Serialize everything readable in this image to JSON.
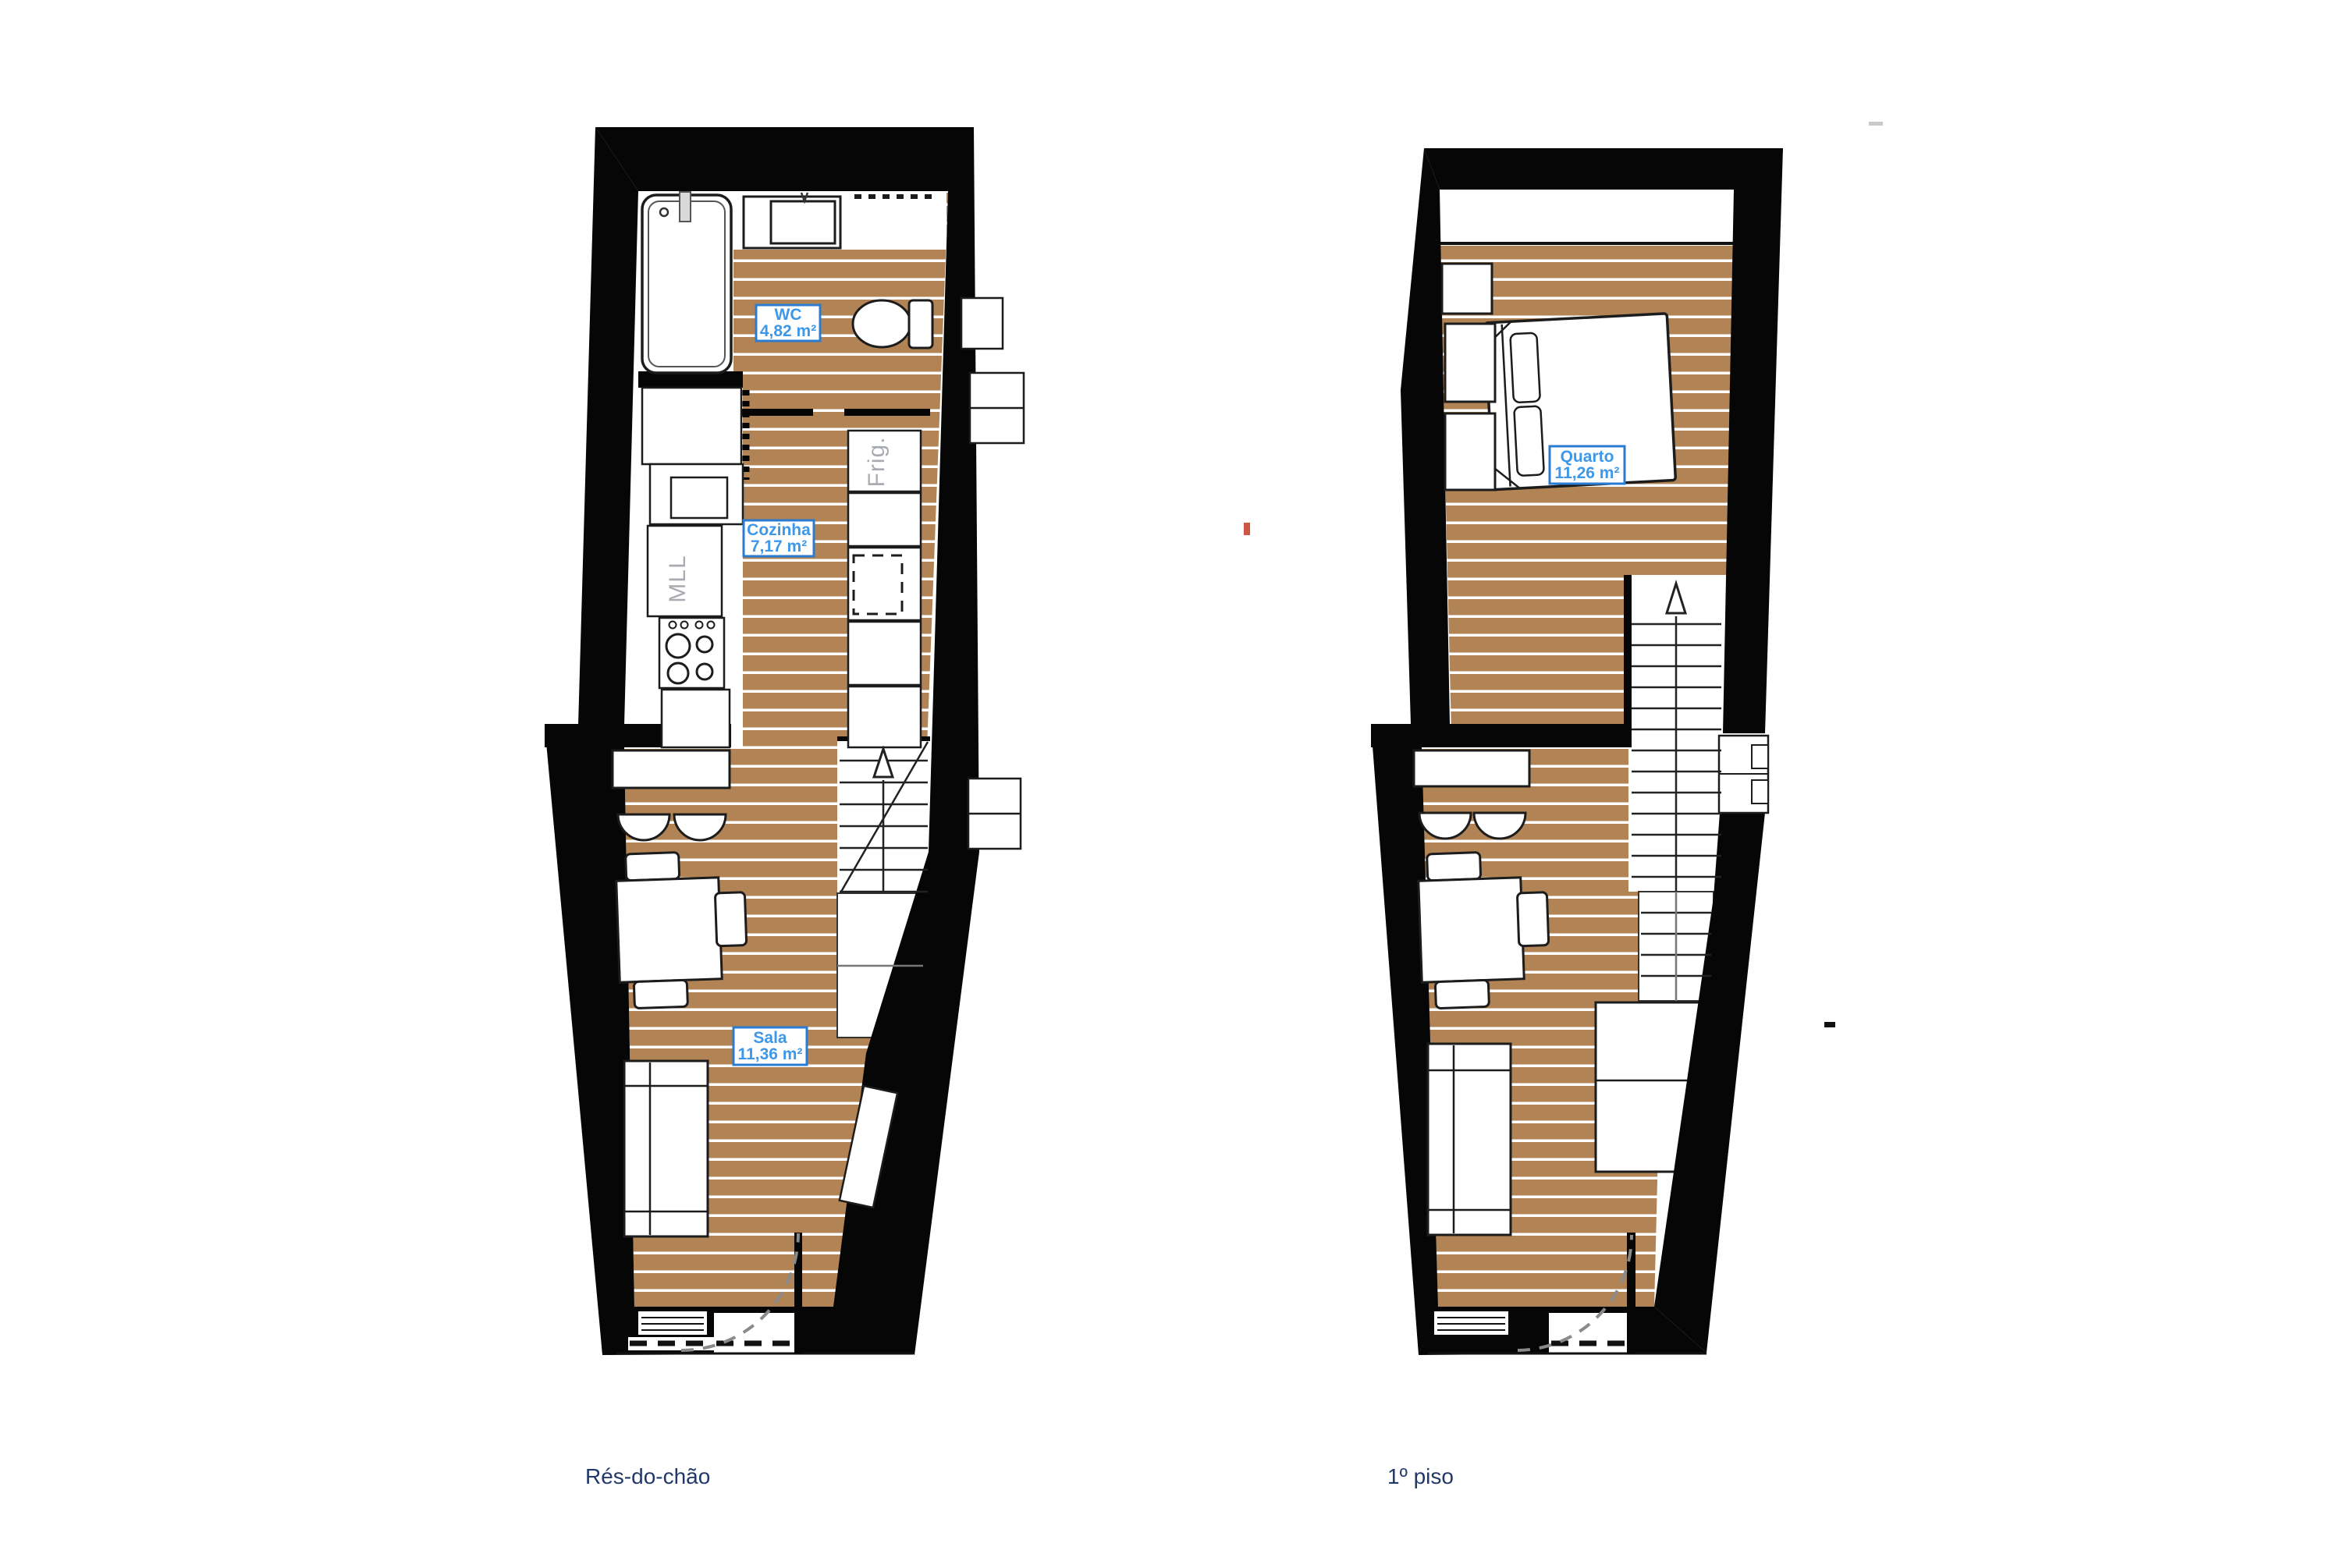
{
  "palette": {
    "wall": "#060606",
    "floor_wood": "#b28455",
    "plank_line": "#ffffff",
    "furniture_fill": "#ffffff",
    "furniture_stroke": "#1c1c1c",
    "soft_stroke": "#8c8c8c",
    "label_border": "#2b7cd0",
    "label_text": "#3f97e8",
    "label_bg": "#ffffff",
    "caption_color": "#21386b",
    "appliance_text": "#a8abb0",
    "door_arc": "#8a8a8a",
    "red_mark": "#cc5544"
  },
  "plans": [
    {
      "caption": "Rés-do-chão",
      "rooms": [
        {
          "name": "WC",
          "area": "4,82 m²"
        },
        {
          "name": "Cozinha",
          "area": "7,17 m²"
        },
        {
          "name": "Sala",
          "area": "11,36 m²"
        }
      ],
      "appliances": [
        {
          "label": "Frig."
        },
        {
          "label": "MLL"
        }
      ]
    },
    {
      "caption": "1º piso",
      "rooms": [
        {
          "name": "Quarto",
          "area": "11,26 m²"
        }
      ]
    }
  ]
}
